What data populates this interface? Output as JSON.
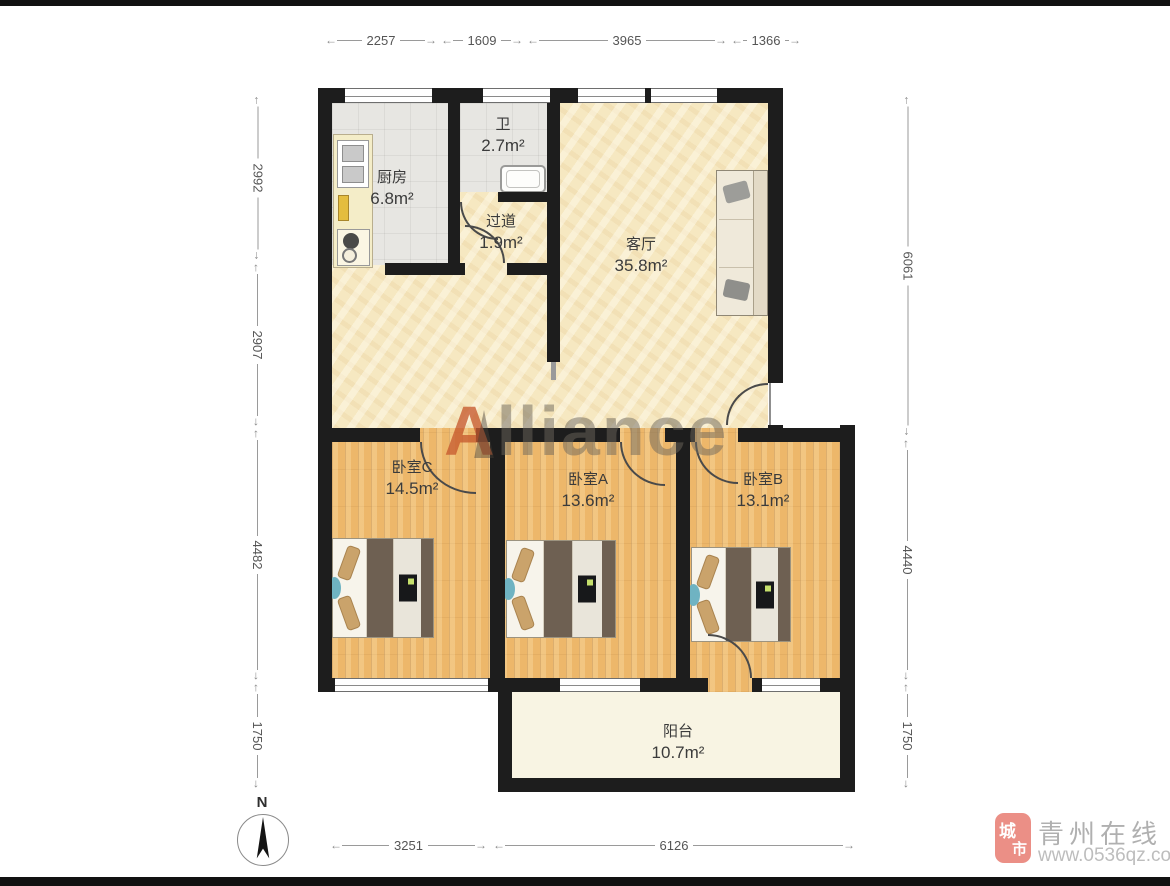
{
  "rooms": {
    "kitchen": {
      "name": "厨房",
      "area": "6.8m²"
    },
    "bath": {
      "name": "卫",
      "area": "2.7m²"
    },
    "hallway": {
      "name": "过道",
      "area": "1.9m²"
    },
    "living": {
      "name": "客厅",
      "area": "35.8m²"
    },
    "bedroom_c": {
      "name": "卧室C",
      "area": "14.5m²"
    },
    "bedroom_a": {
      "name": "卧室A",
      "area": "13.6m²"
    },
    "bedroom_b": {
      "name": "卧室B",
      "area": "13.1m²"
    },
    "balcony": {
      "name": "阳台",
      "area": "10.7m²"
    }
  },
  "dimensions_mm": {
    "top": [
      "2257",
      "1609",
      "3965",
      "1366"
    ],
    "left": [
      "2992",
      "2907",
      "4482",
      "1750"
    ],
    "right": [
      "6061",
      "4440",
      "1750"
    ],
    "bottom": [
      "3251",
      "6126"
    ]
  },
  "compass": {
    "north": "N"
  },
  "watermark": {
    "lead": "A",
    "rest": "lliance"
  },
  "branding": {
    "seal_char_1": "城",
    "seal_char_2": "市",
    "site_name": "青州在线",
    "site_url": "www.0536qz.com"
  },
  "colors": {
    "wall": "#1d1d1d",
    "living_floor": "#f6e8c1",
    "wood_floor": "#edb76a",
    "tile_floor": "#e7e6e2",
    "balcony_floor": "#f8f4e3",
    "watermark_accent": "#c75a2e",
    "brand_pink": "#eb8f86"
  }
}
